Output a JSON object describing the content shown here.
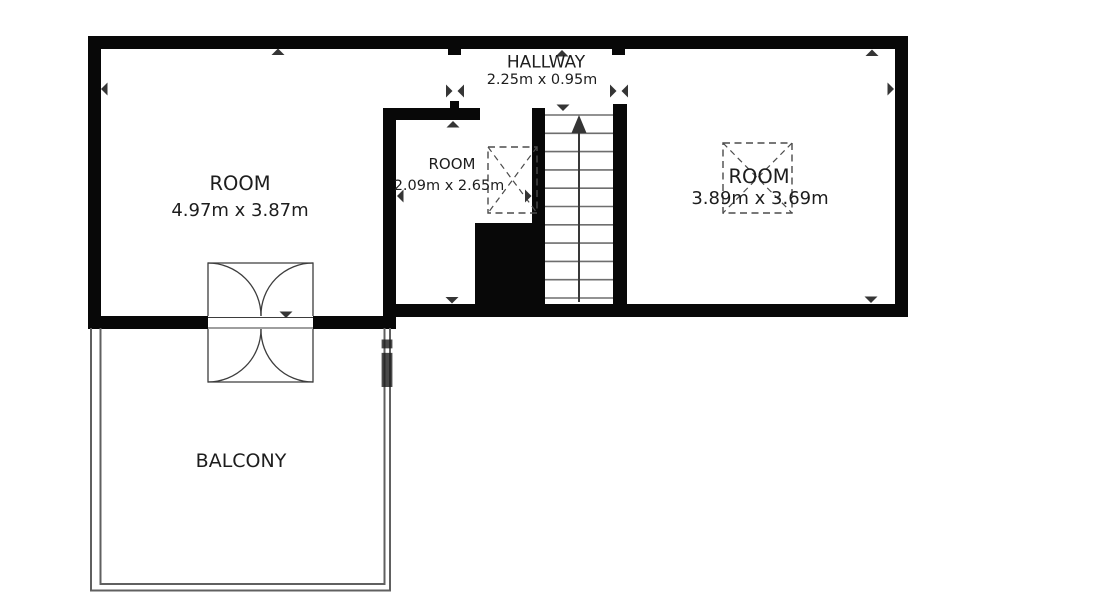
{
  "floorplan": {
    "hallway": {
      "name": "HALLWAY",
      "dims": "2.25m x 0.95m"
    },
    "room_left": {
      "name": "ROOM",
      "dims": "4.97m x 3.87m"
    },
    "room_middle": {
      "name": "ROOM",
      "dims": "2.09m x 2.65m"
    },
    "room_right": {
      "name": "ROOM",
      "dims": "3.89m x 3.69m"
    },
    "balcony": {
      "name": "BALCONY"
    },
    "watermark": "i",
    "stairs_direction": "up",
    "icons": {
      "stairs": "arrow-up-icon",
      "door": "double-swing-door-icon",
      "skylight": "roof-window-cross-icon",
      "ticks": "dimension-tick-icon"
    },
    "colors": {
      "wall": "#080808",
      "line": "#3d3d3d",
      "stair_line": "#6e6e6e",
      "dashed_line": "#4b4b4b",
      "text": "#1d1d1d",
      "balcony_line": "#606060",
      "watermark": "#b5b5b5",
      "background": "#ffffff"
    }
  }
}
